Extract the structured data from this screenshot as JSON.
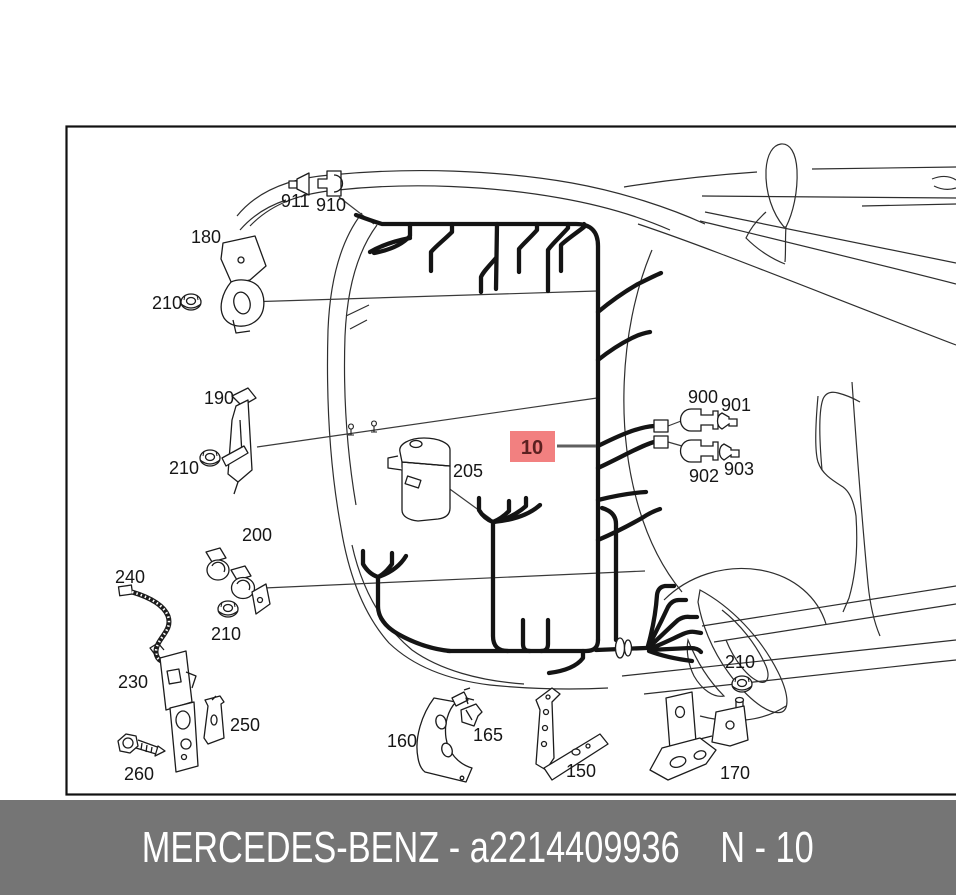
{
  "diagram": {
    "callout": {
      "label": "10"
    },
    "part_labels": [
      {
        "id": "911",
        "text": "911"
      },
      {
        "id": "910",
        "text": "910"
      },
      {
        "id": "180",
        "text": "180"
      },
      {
        "id": "210-a",
        "text": "210"
      },
      {
        "id": "190",
        "text": "190"
      },
      {
        "id": "210-b",
        "text": "210"
      },
      {
        "id": "205",
        "text": "205"
      },
      {
        "id": "900",
        "text": "900"
      },
      {
        "id": "901",
        "text": "901"
      },
      {
        "id": "902",
        "text": "902"
      },
      {
        "id": "903",
        "text": "903"
      },
      {
        "id": "200",
        "text": "200"
      },
      {
        "id": "240",
        "text": "240"
      },
      {
        "id": "210-c",
        "text": "210"
      },
      {
        "id": "230",
        "text": "230"
      },
      {
        "id": "250",
        "text": "250"
      },
      {
        "id": "260",
        "text": "260"
      },
      {
        "id": "160",
        "text": "160"
      },
      {
        "id": "165",
        "text": "165"
      },
      {
        "id": "150",
        "text": "150"
      },
      {
        "id": "170",
        "text": "170"
      },
      {
        "id": "210-d",
        "text": "210"
      }
    ]
  },
  "footer": {
    "brand_and_part": "MERCEDES-BENZ - a2214409936",
    "page_ref": "N - 10"
  },
  "colors": {
    "highlight_fill": "#f28080",
    "highlight_text": "#5b2020",
    "footer_bg": "#757575",
    "footer_text": "#ffffff",
    "line": "#1c1c1c"
  }
}
